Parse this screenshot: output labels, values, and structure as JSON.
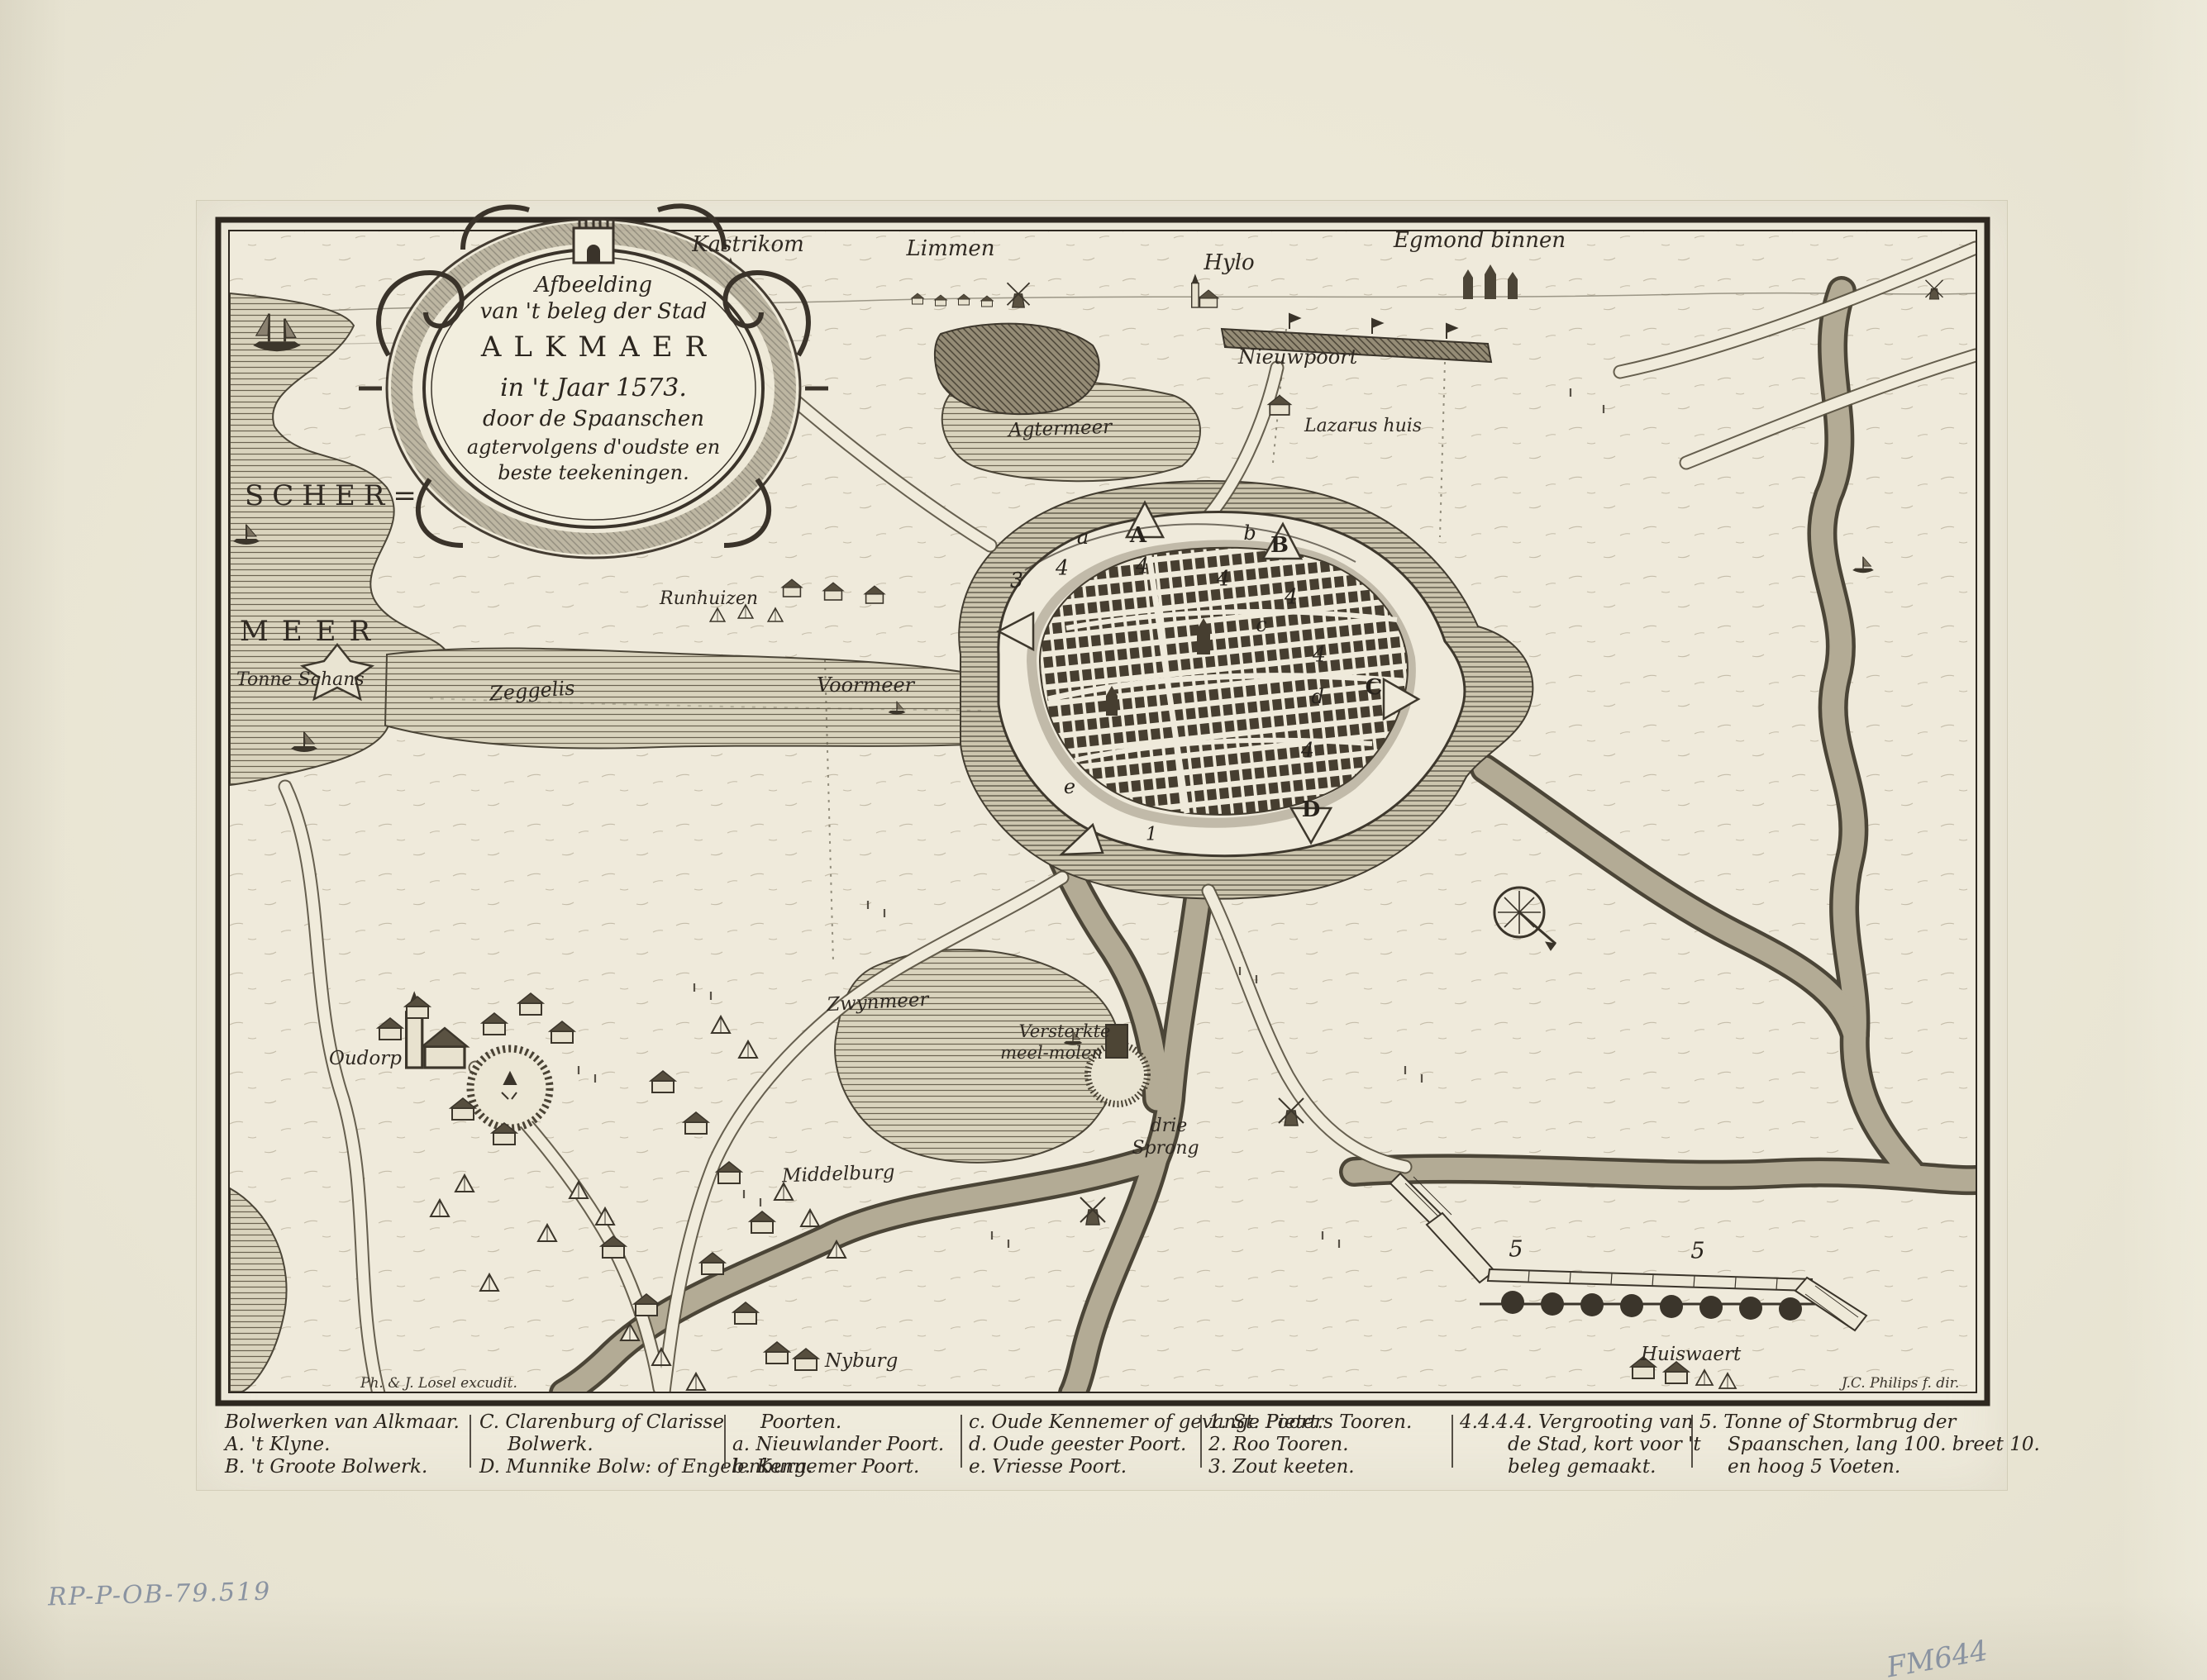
{
  "artwork": {
    "kind": "Engraved map of the siege of Alkmaar, 1573",
    "paper_color": "#ebe7d6",
    "ink_color": "#322c24",
    "pencil_color": "#8a93a1"
  },
  "cartouche": {
    "line1": "Afbeelding",
    "line2": "van 't beleg der Stad",
    "line3": "ALKMAER",
    "line4": "in 't Jaar 1573.",
    "line5": "door de Spaanschen",
    "line6": "agtervolgens d'oudste en",
    "line7": "beste teekeningen."
  },
  "labels": {
    "kastrikom": "Kastrikom",
    "limmen": "Limmen",
    "hylo": "Hylo",
    "egmond_binnen": "Egmond binnen",
    "nieuwpoort": "Nieuwpoort",
    "lazarus_huis": "Lazarus huis",
    "agtermeer": "Agtermeer",
    "scher": "SCHER=",
    "meer": "MEER",
    "tonne_schans": "Tonne Schans",
    "runhuizen": "Runhuizen",
    "zeggelis": "Zeggelis",
    "voormeer": "Voormeer",
    "zwynmeer": "Zwynmeer",
    "oudorp": "Oudorp",
    "versterkte_line1": "Versterkte",
    "versterkte_line2": "meel-molen",
    "drie": "drie",
    "sprong": "Sprong",
    "middelburg": "Middelburg",
    "nyburg": "Nyburg",
    "huiswaert": "Huiswaert"
  },
  "markers": {
    "A": "A",
    "B": "B",
    "C": "C",
    "D": "D",
    "a": "a",
    "b": "b",
    "c": "c",
    "d": "d",
    "e": "e",
    "n1": "1",
    "n3": "3",
    "n4_1": "4",
    "n4_2": "4",
    "n4_3": "4",
    "n4_4": "4",
    "n4_5": "4",
    "n4_6": "4",
    "n5_1": "5",
    "n5_2": "5"
  },
  "signatures": {
    "publisher": "Ph. & J. Losel excudit.",
    "engraver": "J.C. Philips f. dir."
  },
  "legend": {
    "col1": {
      "line1": "Bolwerken van Alkmaar.",
      "line2": "A. 't Klyne.",
      "line3": "B. 't Groote Bolwerk."
    },
    "col2": {
      "line1": "C. Clarenburg of Clarisse",
      "line2": "Bolwerk.",
      "line3": "D. Munnike Bolw: of Engelenburg."
    },
    "col3": {
      "line1": "Poorten.",
      "line2": "a. Nieuwlander Poort.",
      "line3": "b. Kennemer Poort."
    },
    "col4": {
      "line1": "c. Oude Kennemer of gevange Poort.",
      "line2": "d. Oude geester Poort.",
      "line3": "e. Vriesse Poort."
    },
    "col5": {
      "line1": "1. St. Pieters Tooren.",
      "line2": "2. Roo Tooren.",
      "line3": "3. Zout keeten."
    },
    "col6": {
      "line1": "4.4.4.4. Vergrooting van",
      "line2": "de Stad, kort voor 't",
      "line3": "beleg gemaakt."
    },
    "col7": {
      "line1": "5. Tonne of Stormbrug der",
      "line2": "Spaanschen, lang 100. breet 10.",
      "line3": "en hoog 5 Voeten."
    }
  },
  "inscriptions": {
    "catalog": "RP-P-OB-79.519",
    "collection": "FM644"
  }
}
